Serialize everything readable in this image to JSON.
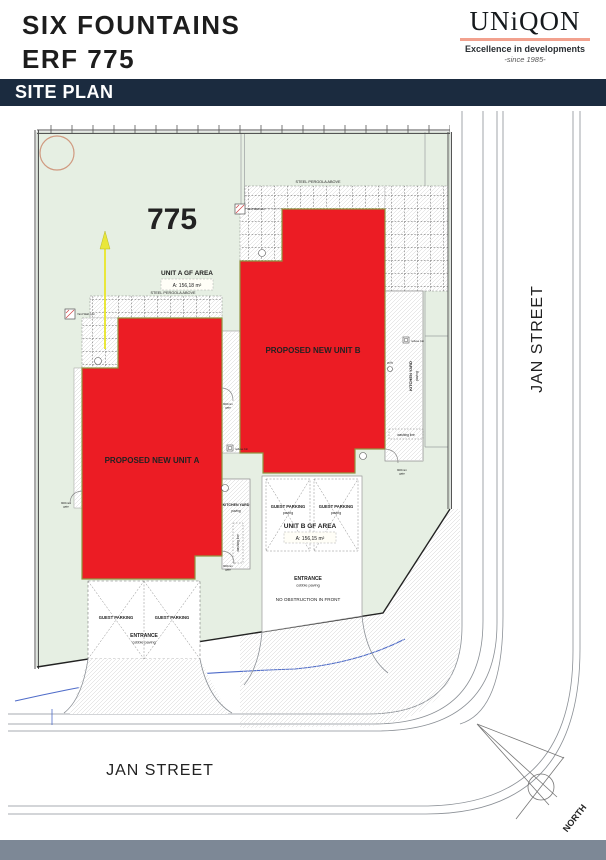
{
  "header": {
    "title_line1": "SIX FOUNTAINS",
    "title_line2": "ERF 775"
  },
  "logo": {
    "name": "UNiQON",
    "tagline": "Excellence in developments",
    "since": "-since 1985-"
  },
  "banner": {
    "title": "SITE PLAN"
  },
  "plan": {
    "erf_number": "775",
    "unit_a": {
      "label": "PROPOSED NEW UNIT A",
      "area_title": "UNIT A GF AREA",
      "area_value": "A: 156,18 m²"
    },
    "unit_b": {
      "label": "PROPOSED NEW UNIT B",
      "area_title": "UNIT B GF AREA",
      "area_value": "A: 156,15 m²"
    },
    "labels": {
      "steel_pergola": "STEEL PERGOLA ABOVE",
      "guest_parking": "GUEST PARKING",
      "paving": "paving",
      "entrance": "ENTRANCE",
      "cobble_paving": "cobble paving",
      "no_obstruction": "NO OBSTRUCTION IN FRONT",
      "kitchen_yard": "KITCHEN YARD",
      "washing_line": "washing line",
      "refuse_bin": "refuse bin",
      "gate_size": "900mm",
      "gate_word": "gate",
      "gully": "gully",
      "wall_over": "Yard Wall over",
      "jan_street": "JAN STREET",
      "north": "NORTH"
    },
    "colors": {
      "site_green": "#e6efe3",
      "unit_red": "#ec1c24",
      "frame": "#7d8896",
      "banner_navy": "#1b2b3f",
      "logo_accent": "#f2a18e",
      "service_blue": "#4f6cc9",
      "tree": "#d09a80",
      "arrow_yellow": "#e9e73b"
    }
  }
}
